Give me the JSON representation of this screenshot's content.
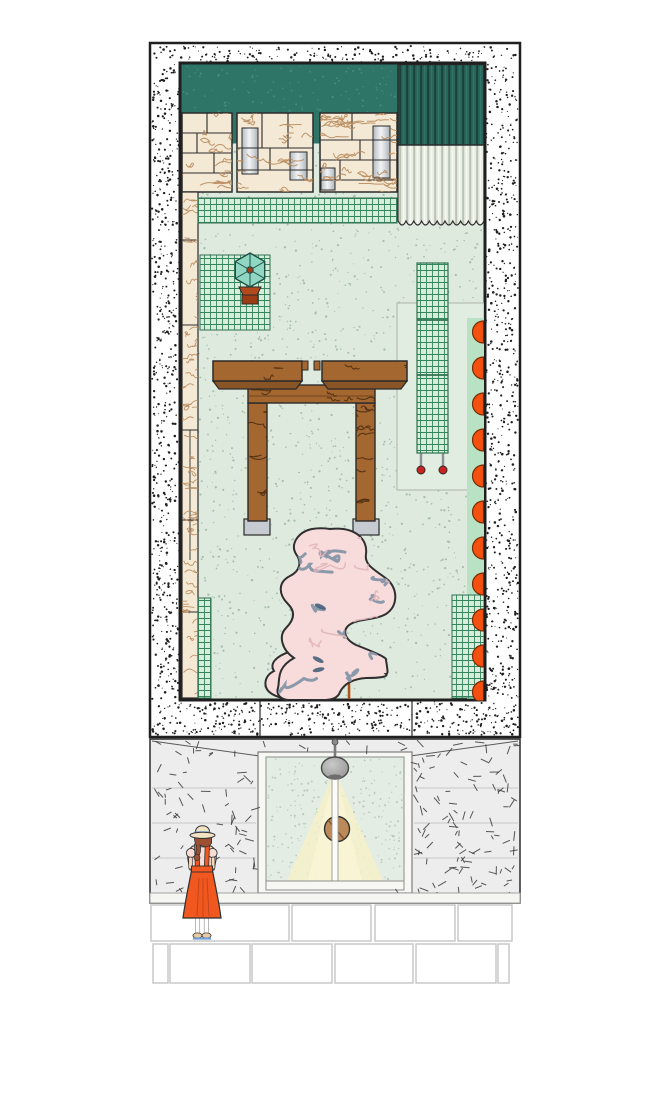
{
  "scene": {
    "kind": "architectural-illustration",
    "views": [
      {
        "name": "floor-plan",
        "border": "stippled"
      },
      {
        "name": "street-elevation",
        "feature": "glass-door-with-pendant-lamp"
      }
    ]
  },
  "palette": {
    "ink": "#1f1f1f",
    "teal": "#2e7567",
    "tealDot": "#4b8c7e",
    "tealDark": "#2a6458",
    "tealDarkLine": "#17423a",
    "corrPale": "#e9ede4",
    "corrPaleLine": "#b9c3b2",
    "cream": "#f4e9d4",
    "grain": "#b8895c",
    "floor": "#dfeadf",
    "floorDot": "#a5bfab",
    "gridBg": "#d7ecda",
    "gridLine": "#33865b",
    "table": "#a4672f",
    "tableBevel": "#8a5526",
    "tableGrain": "#4a2b12",
    "foot": "#c6cbd1",
    "blob": "#f8dcdc",
    "swirl": "#8695a6",
    "swirlPink": "#e3b7bb",
    "navy": "#47607a",
    "rod": "#b0521c",
    "bead": "#cc1f1f",
    "orange": "#f4500f",
    "mint": "#b9e2c4",
    "outline": "#a9b3a9",
    "wall": "#ededed",
    "dash": "#3a3a3a",
    "joint": "#c6c6c6",
    "frameWhite": "#f7f7f4",
    "glass": "#e4ede3",
    "glassDot": "#b7cbba",
    "beam": "#f6f0c8",
    "beamBright": "#fbf6d8",
    "lamp": "#9c9c9c",
    "handle": "#bb8a58",
    "tile": "#ffffff",
    "tileLine": "#c9c9c9",
    "skin": "#f6d7ba",
    "blouse": "#f7ddd6",
    "dress": "#f1581f",
    "dressDark": "#c8431a",
    "hat": "#f0e4c4",
    "hatBand": "#6f9ed9",
    "hair": "#9c4f33",
    "umbrella": "#8fd7c3",
    "umbrellaDot": "#a03a1a",
    "pot": "#b34a1e",
    "potDark": "#9c3c14",
    "wheel": "#cc2222"
  },
  "plan": {
    "semicircles": {
      "count": 11,
      "start_y": 332,
      "spacing": 36,
      "radius": 11,
      "x": 483.5
    },
    "bottom_band_dividers": [
      260,
      412
    ],
    "elements": [
      "teal-wall-band",
      "wood-block-wall",
      "pleated-screen",
      "grid-mats",
      "umbrella-plant",
      "slab-table",
      "mesh-screen-on-casters",
      "marble-blob-sculpture",
      "orange-wall-lights"
    ]
  },
  "elevation": {
    "joint_lines_y": [
      788,
      823,
      858
    ],
    "elements": [
      "pendant-lamp",
      "light-beam",
      "double-glass-door",
      "round-wood-handle"
    ]
  },
  "tiles": {
    "row1_y": 905,
    "row1_h": 36,
    "row1": [
      [
        151,
        138
      ],
      [
        292,
        79
      ],
      [
        375,
        80
      ],
      [
        458,
        54
      ]
    ],
    "row2_y": 944,
    "row2_h": 39,
    "row2": [
      [
        153,
        15
      ],
      [
        170,
        80
      ],
      [
        252,
        80
      ],
      [
        335,
        78
      ],
      [
        416,
        80
      ],
      [
        498,
        11
      ]
    ]
  },
  "person": {
    "pose": "standing-back-view",
    "outfit": [
      "straw-hat-blue-band",
      "pink-blouse",
      "orange-pinafore-dress",
      "blue-sandals"
    ]
  }
}
